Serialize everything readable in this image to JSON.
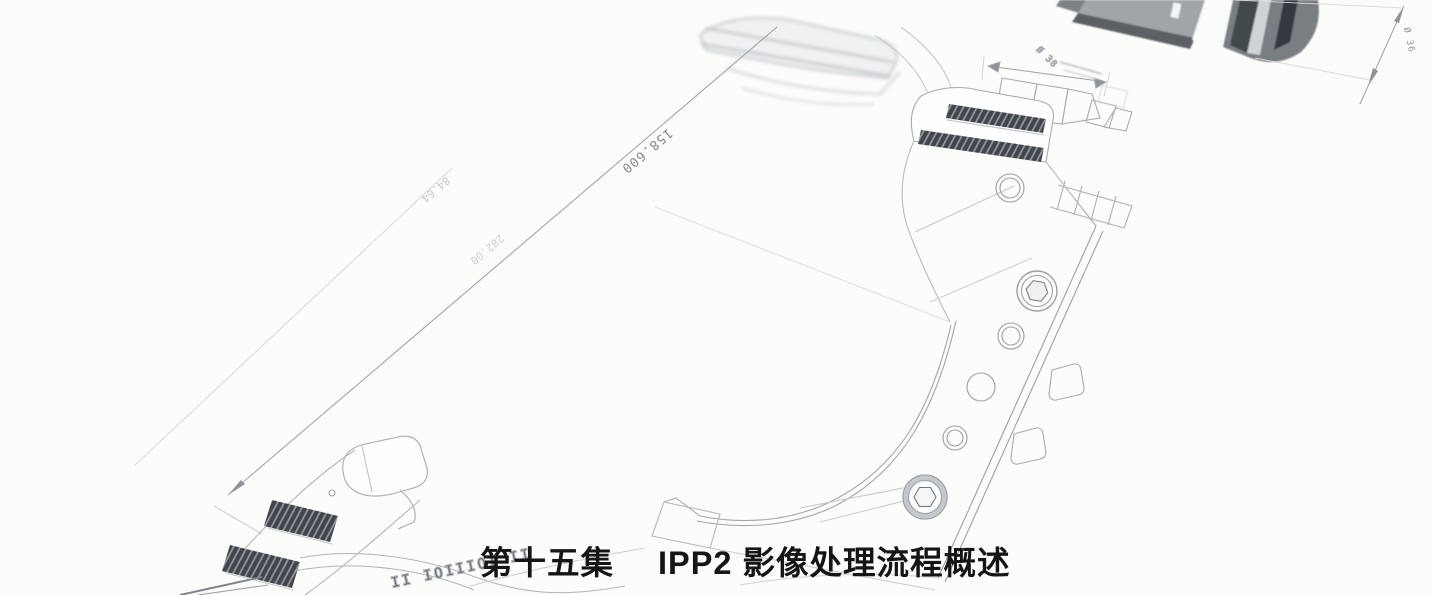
{
  "caption": {
    "episode_label": "第十五集",
    "title": "IPP2 影像处理流程概述"
  },
  "drawing": {
    "type": "cad-wireframe-blueprint",
    "dimension_labels": {
      "main_length": "158.600",
      "top_diameter": "Ø 38",
      "right_diameter": "Ø 36",
      "faint_left_upper": "84.64",
      "faint_left_lower": "282.00"
    },
    "embossed_text": "II IOIIIOI II"
  },
  "colors": {
    "background": "#fcfcfb",
    "line_light": "#cdd1d4",
    "line_mid": "#a6acb1",
    "line_dark": "#858b90",
    "knurl_dark": "#41464c",
    "caption_text": "#151515",
    "photo_dark": "#3a3f44",
    "photo_mid": "#7a8084",
    "photo_light": "#9fa5a8"
  }
}
